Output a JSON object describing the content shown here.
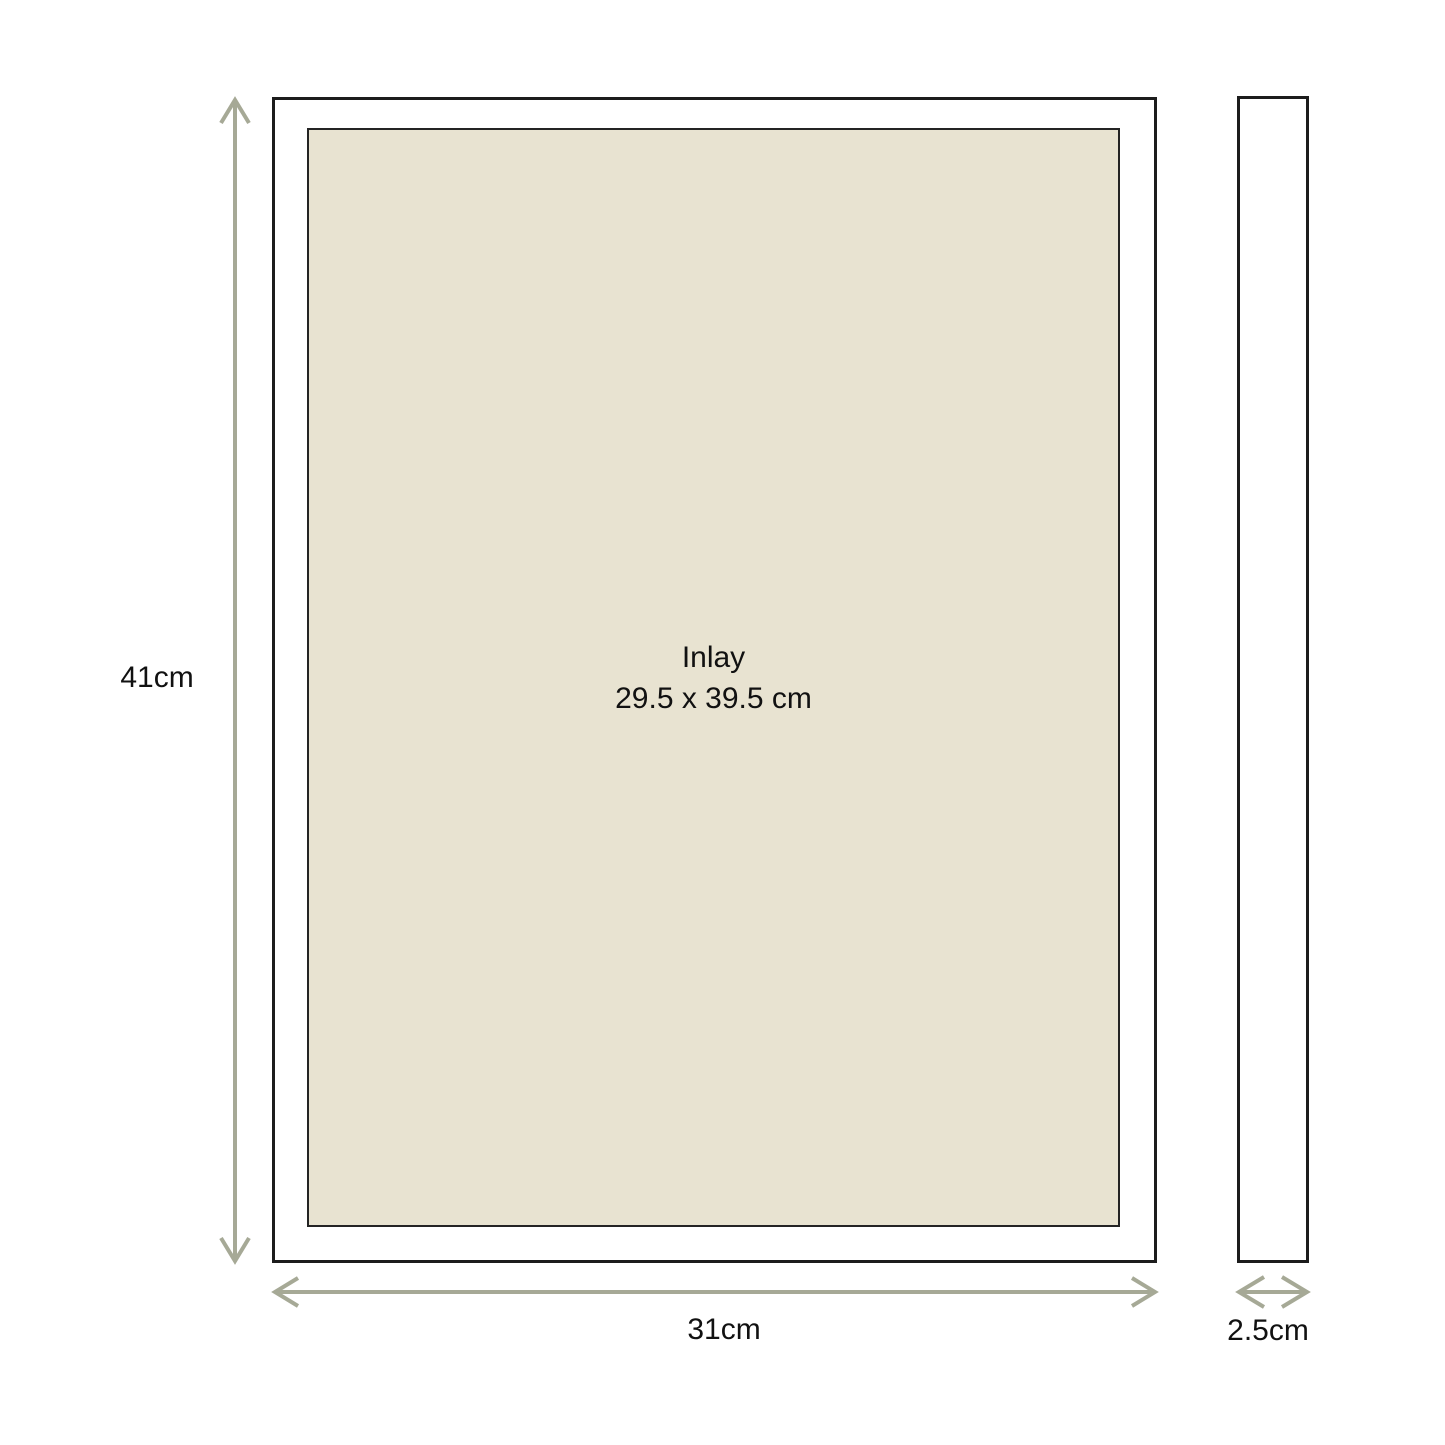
{
  "colors": {
    "background": "#ffffff",
    "arrow": "#a6a996",
    "frame_border": "#1c1c1c",
    "frame_fill": "#ffffff",
    "inlay_fill": "#e8e3d1",
    "inlay_border": "#242424",
    "text": "#111111"
  },
  "front_view": {
    "inlay_title": "Inlay",
    "inlay_size": "29.5 x 39.5 cm"
  },
  "labels": {
    "height": "41cm",
    "width": "31cm",
    "depth": "2.5cm"
  }
}
